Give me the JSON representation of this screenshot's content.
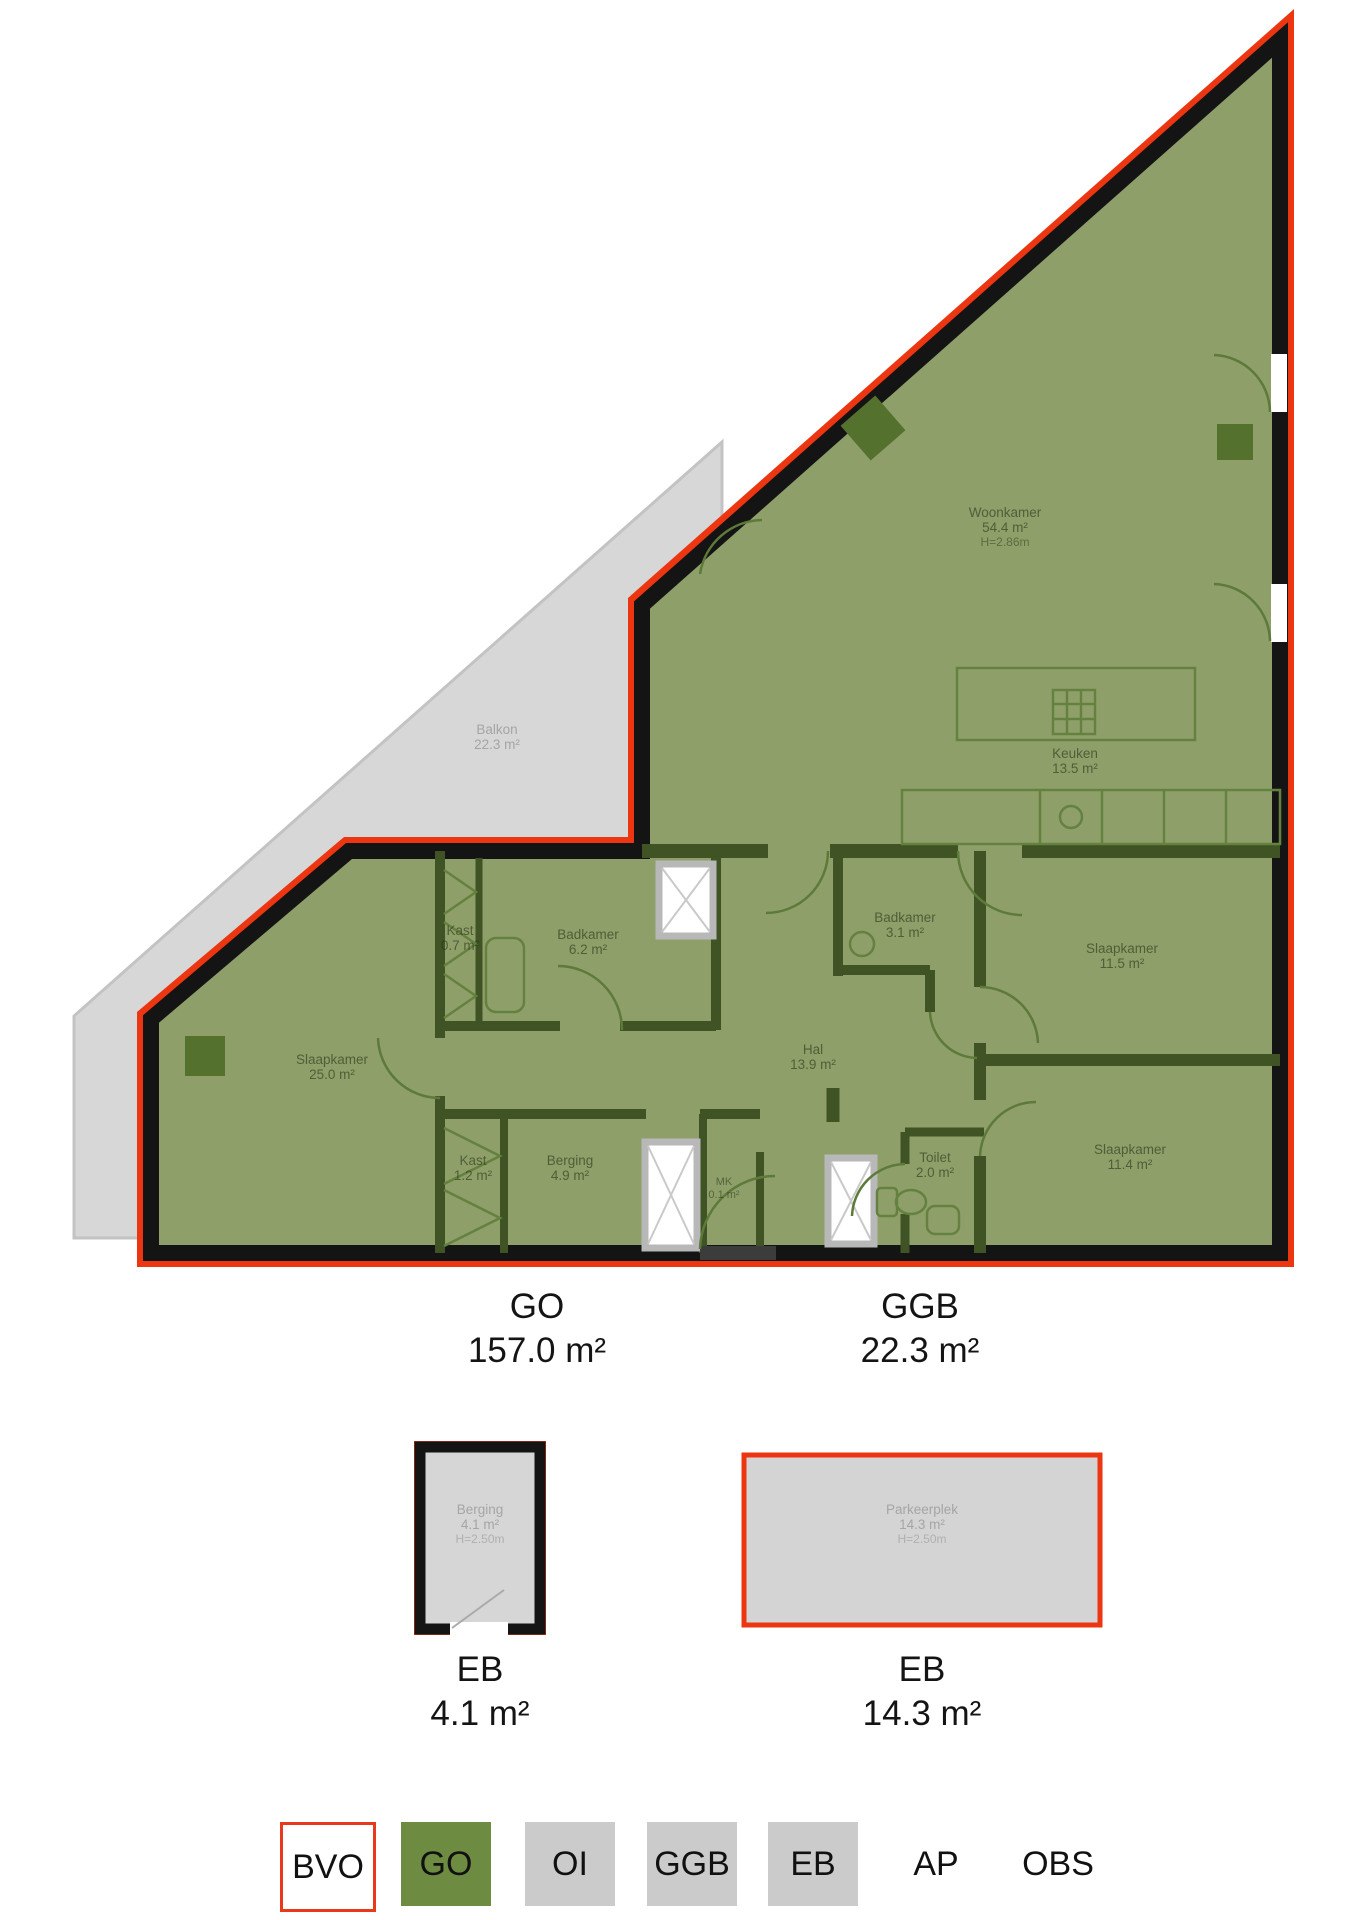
{
  "palette": {
    "go_green": "#8e9f6a",
    "interior_wall_green": "#3f5324",
    "wall_black": "#141414",
    "outline_red": "#ec3612",
    "balcony_gray": "#d7d7d7",
    "annex_gray": "#d5d5d5",
    "legend_gray": "#cbcbcb",
    "legend_green": "#6e8c41"
  },
  "plan": {
    "rooms": [
      {
        "name": "Woonkamer",
        "area": "54.4 m²",
        "height": "H=2.86m"
      },
      {
        "name": "Keuken",
        "area": "13.5 m²"
      },
      {
        "name": "Balkon",
        "area": "22.3 m²"
      },
      {
        "name": "Kast",
        "area": "0.7 m²"
      },
      {
        "name": "Badkamer",
        "area": "6.2 m²"
      },
      {
        "name": "Badkamer",
        "area": "3.1 m²"
      },
      {
        "name": "Slaapkamer",
        "area": "11.5 m²"
      },
      {
        "name": "Slaapkamer",
        "area": "25.0 m²"
      },
      {
        "name": "Hal",
        "area": "13.9 m²"
      },
      {
        "name": "Kast",
        "area": "1.2 m²"
      },
      {
        "name": "Berging",
        "area": "4.9 m²"
      },
      {
        "name": "MK",
        "area": "0.1 m²"
      },
      {
        "name": "Toilet",
        "area": "2.0 m²"
      },
      {
        "name": "Slaapkamer",
        "area": "11.4 m²"
      }
    ],
    "summaries": [
      {
        "code": "GO",
        "area": "157.0 m²"
      },
      {
        "code": "GGB",
        "area": "22.3 m²"
      }
    ]
  },
  "annexes": [
    {
      "name": "Berging",
      "area": "4.1 m²",
      "height": "H=2.50m",
      "summary_code": "EB",
      "summary_area": "4.1 m²"
    },
    {
      "name": "Parkeerplek",
      "area": "14.3 m²",
      "height": "H=2.50m",
      "summary_code": "EB",
      "summary_area": "14.3 m²"
    }
  ],
  "legend": {
    "items": [
      {
        "label": "BVO",
        "swatch": "outlined"
      },
      {
        "label": "GO",
        "swatch": "green"
      },
      {
        "label": "OI",
        "swatch": "gray"
      },
      {
        "label": "GGB",
        "swatch": "gray"
      },
      {
        "label": "EB",
        "swatch": "gray"
      },
      {
        "label": "AP",
        "swatch": "none"
      },
      {
        "label": "OBS",
        "swatch": "none"
      }
    ]
  }
}
